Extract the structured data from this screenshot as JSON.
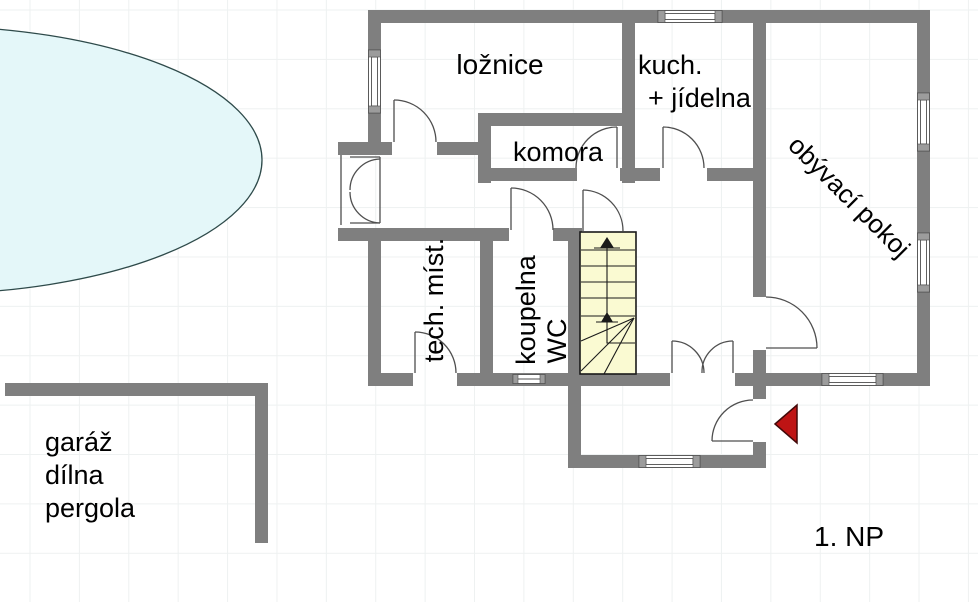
{
  "floor_label": "1. NP",
  "rooms": {
    "bedroom": {
      "label": "ložnice"
    },
    "kitchen_dining": {
      "line1": "kuch.",
      "line2": "+ jídelna"
    },
    "pantry": {
      "label": "komora"
    },
    "living_room": {
      "label": "obývací pokoj"
    },
    "utility_room": {
      "label": "tech. míst."
    },
    "bathroom": {
      "line1": "koupelna",
      "line2": "WC"
    }
  },
  "outbuilding": {
    "line1": "garáž",
    "line2": "dílna",
    "line3": "pergola"
  },
  "symbols": {
    "entrance_arrow_direction": "left",
    "stairs_direction": "up"
  },
  "colors": {
    "wall": "#7f7f7f",
    "door": "#4f4f4f",
    "window-cap": "#9c9c9c",
    "pool-fill": "#e4f7f9",
    "pool-stroke": "#2e4a4a",
    "stairs-fill": "#fafad2",
    "stairs-stroke": "#1a1a1a",
    "arrow-fill": "#be1414",
    "arrow-stroke": "#420808",
    "text": "#000000",
    "grid": "#eef1f1"
  }
}
